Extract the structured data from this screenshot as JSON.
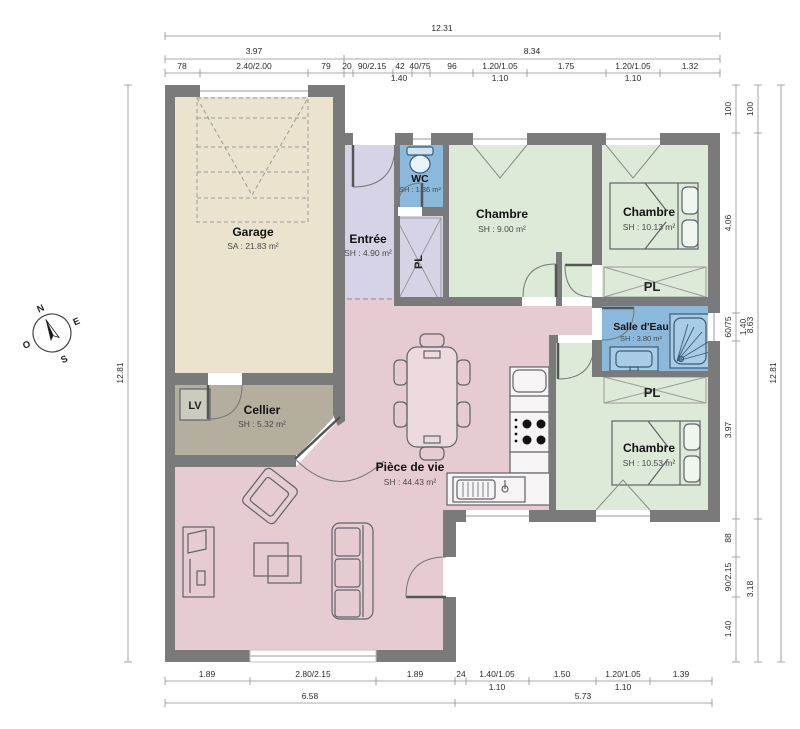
{
  "rooms": {
    "garage": {
      "name": "Garage",
      "area": "SA : 21.83 m²"
    },
    "entree": {
      "name": "Entrée",
      "area": "SH : 4.90 m²"
    },
    "wc": {
      "name": "WC",
      "area": "SH : 1.36 m²"
    },
    "chambre1": {
      "name": "Chambre",
      "area": "SH : 9.00 m²"
    },
    "chambre2": {
      "name": "Chambre",
      "area": "SH : 10.13 m²"
    },
    "sde": {
      "name": "Salle d'Eau",
      "area": "SH : 3.80 m²"
    },
    "chambre3": {
      "name": "Chambre",
      "area": "SH : 10.53 m²"
    },
    "cellier": {
      "name": "Cellier",
      "area": "SH : 5.32 m²"
    },
    "sejour": {
      "name": "Pièce de vie",
      "area": "SH : 44.43 m²"
    }
  },
  "closets": {
    "pl1": "PL",
    "pl2": "PL",
    "pl3": "PL",
    "lv": "LV"
  },
  "compass": {
    "north": "N",
    "east": "E",
    "south": "S",
    "west": "O"
  },
  "dims": {
    "t_total": "12.31",
    "t_a": "3.97",
    "t_b": "8.34",
    "t3": [
      "78",
      "2.40/2.00",
      "79",
      "20",
      "90/2.15",
      "42",
      "40/75",
      "96",
      "1.20/1.05",
      "1.75",
      "1.20/1.05",
      "1.32"
    ],
    "t4": [
      "1.40",
      "1.10",
      "1.10"
    ],
    "b1": [
      "1.89",
      "2.80/2.15",
      "1.89",
      "24",
      "1.40/1.05",
      "1.50",
      "1.20/1.05",
      "1.39"
    ],
    "b2": [
      "1.10",
      "1.10"
    ],
    "b3": [
      "6.58",
      "5.73"
    ],
    "l_total": "12.81",
    "r1": [
      "100",
      "4.06",
      "60/75",
      "3.97",
      "88",
      "90/2.15",
      "1.40"
    ],
    "r_win": "1.40",
    "r2": [
      "100",
      "8.63",
      "3.18"
    ],
    "r3": "12.81"
  },
  "colors": {
    "wall": "#7a7a7a",
    "garage_floor": "#eae3cd",
    "entree_floor": "#d7d3e6",
    "water_floor": "#8ab9dc",
    "bedroom_floor": "#dcead7",
    "cellier_floor": "#b3ae9e",
    "living_floor": "#e6cbd2"
  }
}
